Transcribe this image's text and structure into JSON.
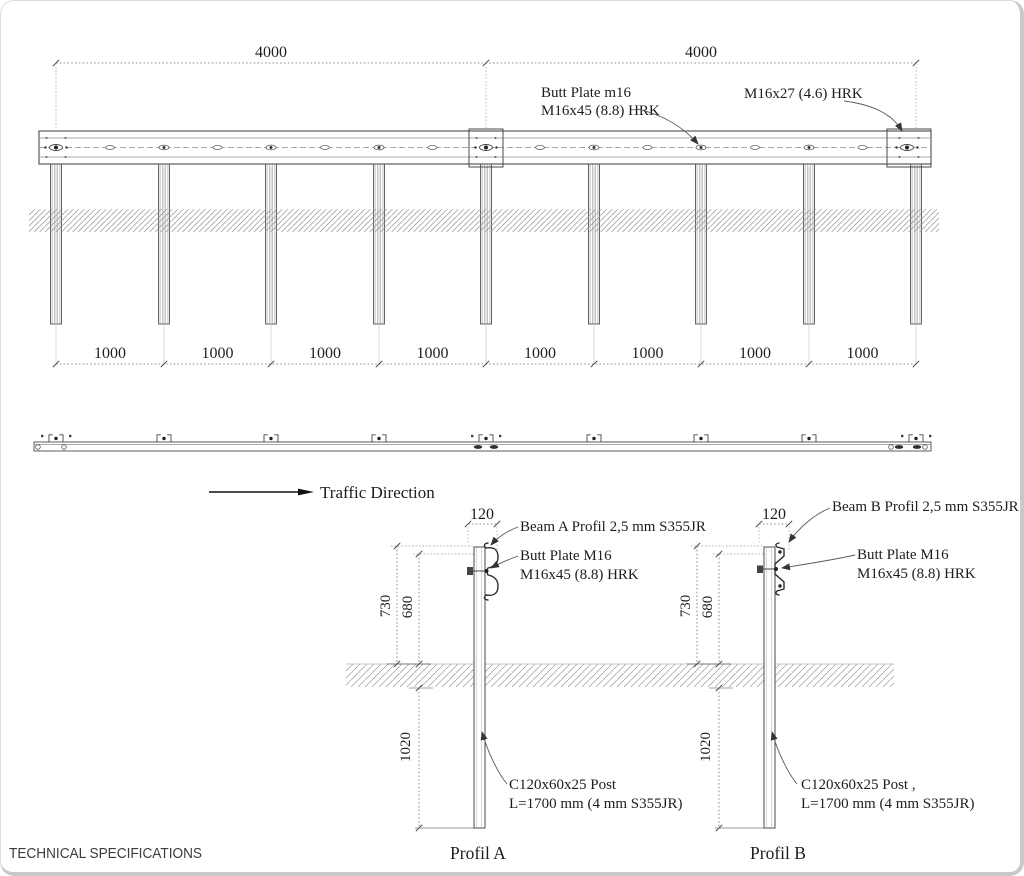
{
  "drawing": {
    "elevation": {
      "span_dims": [
        "4000",
        "4000"
      ],
      "spacing_dims": [
        "1000",
        "1000",
        "1000",
        "1000",
        "1000",
        "1000",
        "1000",
        "1000"
      ],
      "butt_plate_label": {
        "line1": "Butt Plate m16",
        "line2": "M16x45 (8.8) HRK"
      },
      "end_bolt_label": "M16x27 (4.6) HRK"
    },
    "traffic_direction_label": "Traffic Direction",
    "profil_a": {
      "title": "Profil A",
      "dim_width": "120",
      "dim_height_outer": "730",
      "dim_height_inner": "680",
      "dim_embed": "1020",
      "beam_label": "Beam A Profil 2,5 mm S355JR",
      "butt_plate": {
        "line1": "Butt Plate M16",
        "line2": "M16x45 (8.8) HRK"
      },
      "post_label": {
        "line1": "C120x60x25 Post",
        "line2": "L=1700 mm (4 mm S355JR)"
      }
    },
    "profil_b": {
      "title": "Profil B",
      "dim_width": "120",
      "dim_height_outer": "730",
      "dim_height_inner": "680",
      "dim_embed": "1020",
      "beam_label": "Beam B Profil 2,5 mm S355JR",
      "butt_plate": {
        "line1": "Butt Plate M16",
        "line2": "M16x45 (8.8) HRK"
      },
      "post_label": {
        "line1": "C120x60x25 Post ,",
        "line2": "L=1700 mm (4 mm S355JR)"
      }
    },
    "footer_title": "TECHNICAL SPECIFICATIONS",
    "colors": {
      "line": "#4a4a4a",
      "dimension": "#6f6f6f",
      "hatch": "#969696",
      "text": "#1d1d1d",
      "frame": "#c9c9c9",
      "background": "#ffffff"
    }
  }
}
